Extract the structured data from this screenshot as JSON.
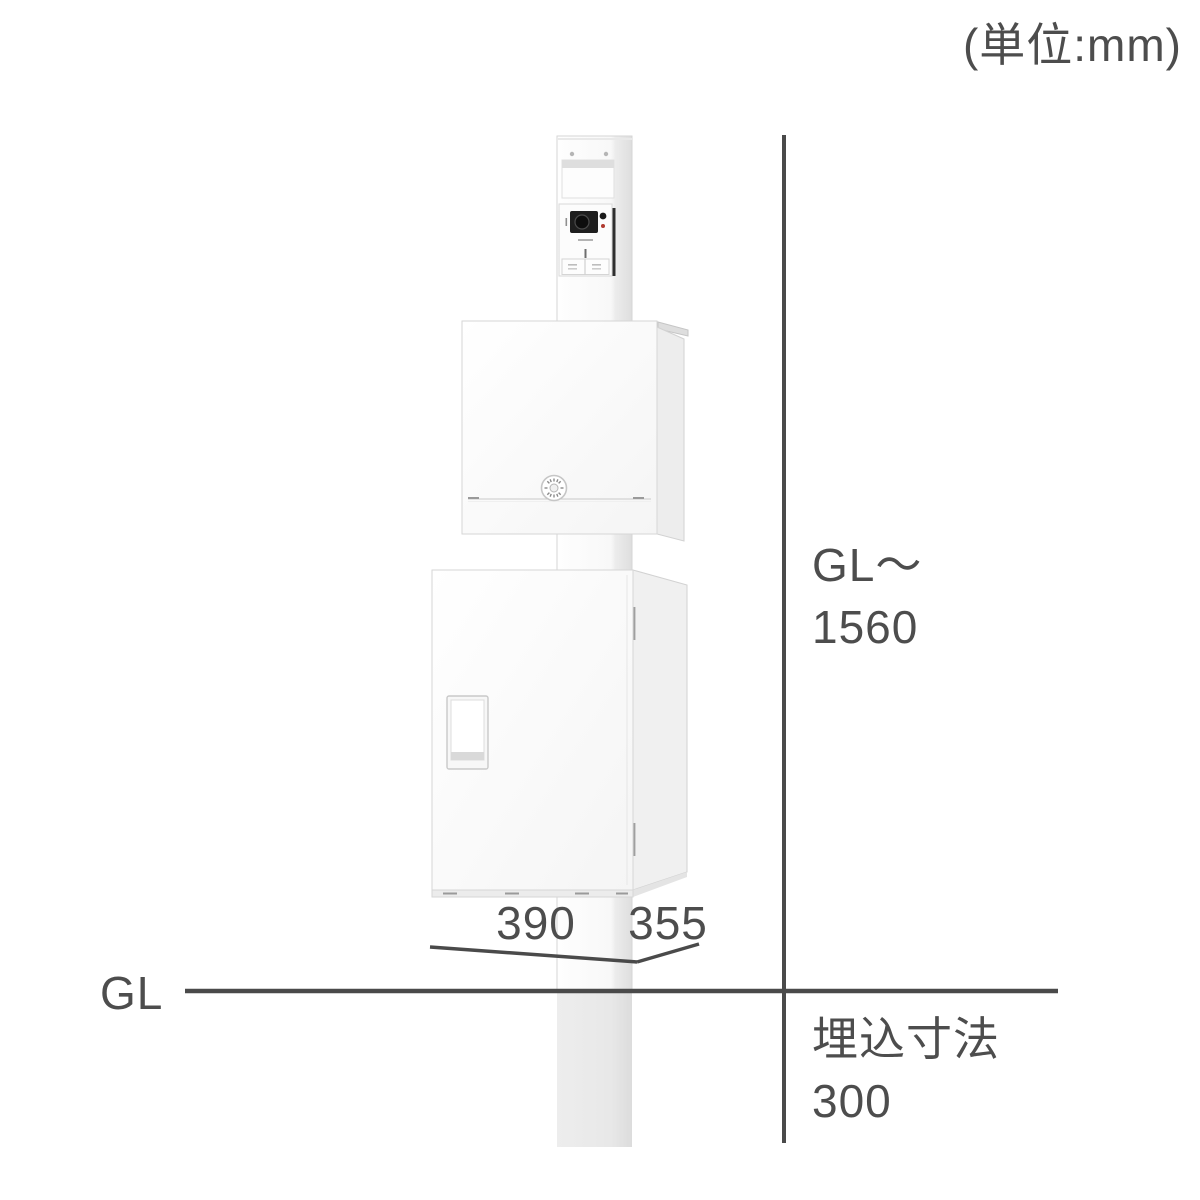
{
  "unit_note": "(単位:mm)",
  "dimensions": {
    "height_from": "GL〜",
    "height_value": "1560",
    "width_value": "390",
    "depth_value": "355",
    "ground_label": "GL",
    "burial_label": "埋込寸法",
    "burial_value": "300"
  },
  "product_parts": {
    "post": "square-post",
    "buried_post": "buried-post-section",
    "nameplate": "nameplate-recess",
    "intercom": "doorphone-camera-unit",
    "mailbox": "mail-post-box",
    "dial_lock": "dial-lock",
    "delivery_box": "delivery-box",
    "handle": "door-handle-recess"
  },
  "colors": {
    "dimension_line": "#4a4a4a",
    "text": "#4d4d4d",
    "product_white": "#ffffff",
    "side_shade": "#efefef",
    "buried_post": "#e9e9e9",
    "camera_black": "#1e1e1e",
    "intercom_led_red": "#b03a30"
  }
}
